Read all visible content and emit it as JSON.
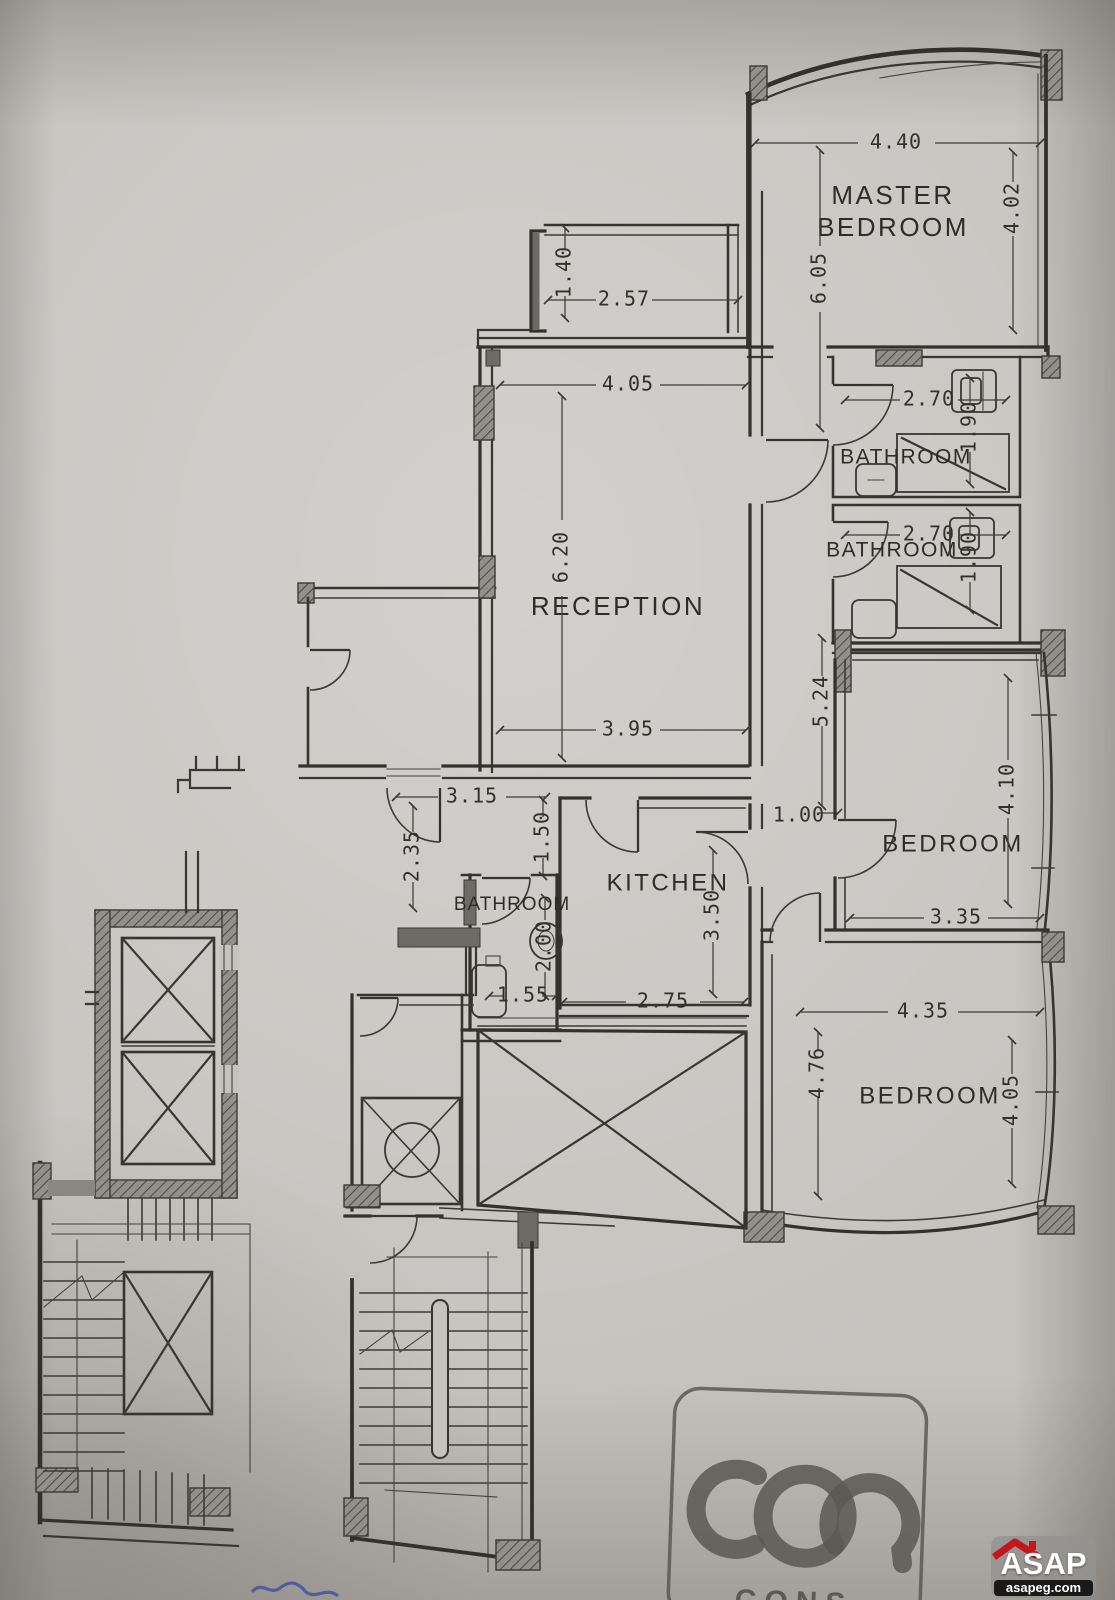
{
  "colors": {
    "paper": "#c6c3bf",
    "ink": "#34312d",
    "stamp_ink": "#5b5853",
    "handwriting_blue": "#3a4a9f",
    "watermark_bg": "#949390",
    "watermark_text": "#ffffff",
    "watermark_bar": "#191919",
    "watermark_roof_red": "#c4161c"
  },
  "rooms": {
    "master_bedroom_line1": "MASTER",
    "master_bedroom_line2": "BEDROOM",
    "bathroom_upper": "BATHROOM",
    "bathroom_middle": "BATHROOM",
    "reception": "RECEPTION",
    "kitchen": "KITCHEN",
    "bathroom_small": "BATHROOM",
    "bedroom_middle": "BEDROOM",
    "bedroom_bottom": "BEDROOM"
  },
  "dims": {
    "master_top": "4.40",
    "master_right": "4.02",
    "master_left": "6.05",
    "bath_upper_w": "2.70",
    "bath_upper_d": "1.90",
    "bath_mid_w": "2.70",
    "bath_mid_d": "1.90",
    "balcony_d": "1.40",
    "balcony_w": "2.57",
    "reception_top": "4.05",
    "reception_h": "6.20",
    "reception_bottom": "3.95",
    "hall_top": "3.15",
    "hall_left": "2.35",
    "hall_mid": "1.50",
    "corridor_h": "5.24",
    "corridor_w": "1.00",
    "bedroom_mid_h": "4.10",
    "bedroom_mid_w": "3.35",
    "kitchen_h": "3.50",
    "kitchen_w": "2.75",
    "bath_small_h": "2.00",
    "bath_small_w": "1.55",
    "bedroom_bot_top": "4.35",
    "bedroom_bot_left": "4.76",
    "bedroom_bot_right": "4.05"
  },
  "stamp": {
    "caption": "CONS"
  },
  "watermark": {
    "brand": "ASAP",
    "domain": "asapeg.com"
  }
}
